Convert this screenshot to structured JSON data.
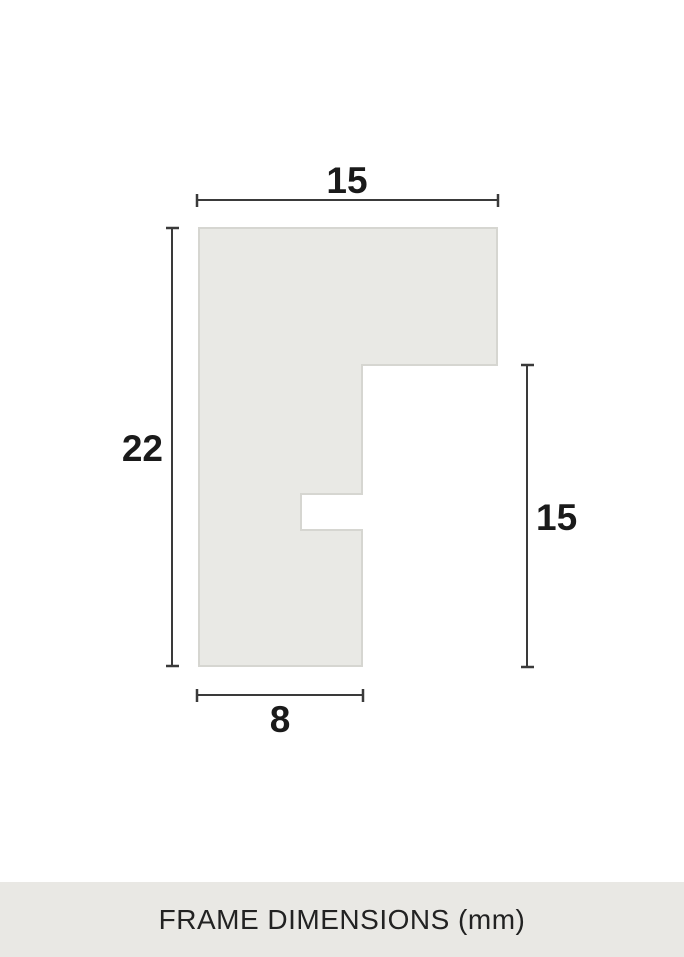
{
  "page": {
    "background": "#ffffff"
  },
  "diagram": {
    "dimensions": {
      "top_width": "15",
      "left_height": "22",
      "right_height": "15",
      "bottom_width": "8"
    },
    "colors": {
      "shape_fill": "#e9e9e5",
      "shape_stroke": "#d6d6d1",
      "dimension_line": "#3a3a3a",
      "label_text": "#1a1a1a"
    }
  },
  "footer": {
    "label": "FRAME DIMENSIONS (mm)",
    "colors": {
      "background": "#e9e8e4",
      "text": "#222222"
    }
  }
}
